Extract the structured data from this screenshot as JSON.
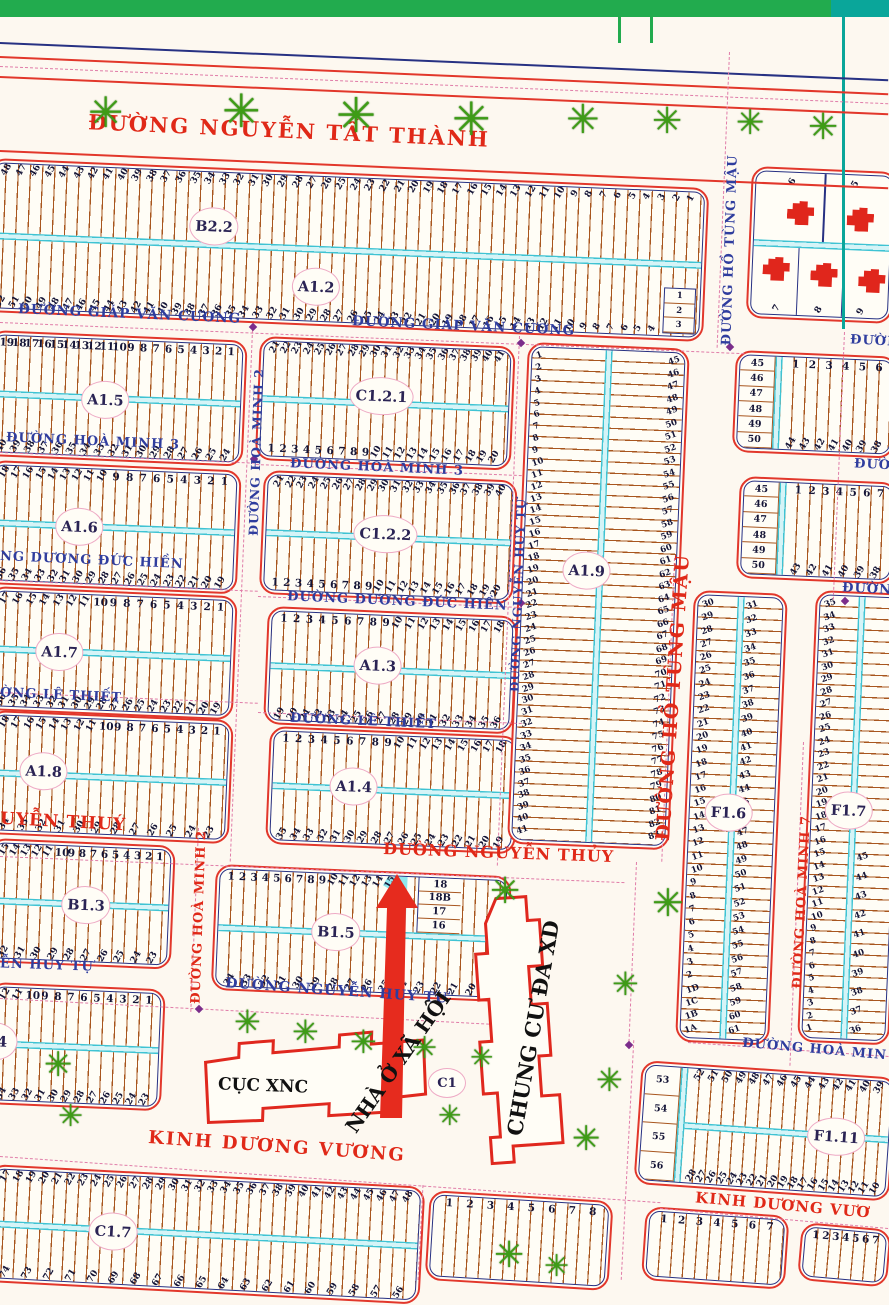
{
  "streets": {
    "nguyen_tat_thanh": "ĐƯỜNG NGUYỄN TẤT THÀNH",
    "giap_van_cuong": "ĐƯỜNG GIÁP VĂN CƯƠNG",
    "ho_tung_mau": "ĐƯỜNG HỒ TÙNG MẬU",
    "hoa_minh_2": "ĐƯỜNG HOÀ MINH 2",
    "hoa_minh_3": "ĐƯỜNG HOÀ MINH 3",
    "hoa_minh_7": "ĐƯỜNG HOÀ MINH 7",
    "hoa_minh_cut": "ĐƯỜNG HOÀ MIN",
    "duong_duc_hien": "ĐƯỜNG DƯƠNG ĐỨC HIỀN",
    "duong_duc_hien_cut": "NG DƯƠNG ĐỨC HIỀN",
    "le_thiet": "ĐƯỜNG LÊ THIẾT",
    "le_thiet_cut": "ỜNG LÊ THIẾT",
    "nguyen_thuy": "ĐƯỜNG NGUYỄN THỦY",
    "nguyen_thuy_cut": "UYỄN THUÝ",
    "nguyen_huy_tu": "ĐƯỜNG NGUYỄN HUY TỰ",
    "nguyen_huy_tu_cut": "ỄN HUY TỰ",
    "kinh_duong_vuong": "KINH DƯƠNG VƯƠNG",
    "kinh_duong_vuong_cut": "KINH DƯƠNG VƯƠ",
    "duong_cut": "ĐƯỜNG"
  },
  "places": {
    "cuc_xnc": "CỤC XNC",
    "nha_o_xa_hoi": "NHÀ Ở XÃ HỘI",
    "chung_cu": "CHUNG CƯ ĐA XD",
    "c1_label": "C1"
  },
  "icons": {
    "tree": "✳"
  },
  "blocks": {
    "b22": {
      "label": "B2.2",
      "top": [
        "48",
        "47",
        "46",
        "45",
        "44",
        "43",
        "42",
        "41",
        "40",
        "39",
        "38",
        "37",
        "36",
        "35",
        "34",
        "33",
        "32",
        "31",
        "30",
        "29",
        "28",
        "27",
        "26",
        "25",
        "24",
        "23",
        "22",
        "21",
        "20",
        "19",
        "18",
        "17",
        "16",
        "15",
        "14",
        "13",
        "12",
        "11",
        "10",
        "9",
        "8",
        "7",
        "6",
        "5",
        "4",
        "3",
        "2",
        "1"
      ]
    },
    "a12": {
      "label": "A1.2",
      "bottom": [
        "52",
        "51",
        "50",
        "49",
        "48",
        "47",
        "46",
        "45",
        "44",
        "43",
        "42",
        "41",
        "40",
        "39",
        "38",
        "37",
        "36",
        "35",
        "34",
        "33",
        "32",
        "31",
        "30",
        "29",
        "28",
        "27",
        "26",
        "25",
        "24",
        "23",
        "22",
        "21",
        "20",
        "19",
        "18",
        "17",
        "16",
        "15",
        "14",
        "13",
        "12",
        "11",
        "10",
        "9",
        "8",
        "7",
        "6",
        "5",
        "4"
      ],
      "corner": [
        "1",
        "2",
        "3"
      ]
    },
    "tr": {
      "top": [
        "6",
        "5"
      ],
      "bottom": [
        "7",
        "8",
        "9"
      ]
    },
    "a15": {
      "label": "A1.5",
      "top": [
        "19",
        "18",
        "17",
        "16",
        "15",
        "14",
        "13",
        "12",
        "11",
        "10",
        "9",
        "8",
        "7",
        "6",
        "5",
        "4",
        "3",
        "2",
        "1"
      ],
      "bottom": [
        "40",
        "39",
        "38",
        "37",
        "36",
        "35",
        "34",
        "33",
        "32",
        "31",
        "30",
        "29",
        "28",
        "27",
        "26",
        "25",
        "24"
      ]
    },
    "a16": {
      "label": "A1.6",
      "toprot": [
        "18",
        "17",
        "16",
        "15",
        "14",
        "13",
        "12",
        "11",
        "10"
      ],
      "topup": [
        "9",
        "8",
        "7",
        "6",
        "5",
        "4",
        "3",
        "2",
        "1"
      ],
      "bottom": [
        "36",
        "35",
        "34",
        "33",
        "32",
        "31",
        "30",
        "29",
        "28",
        "27",
        "26",
        "25",
        "24",
        "23",
        "22",
        "21",
        "20",
        "19"
      ]
    },
    "a17": {
      "label": "A1.7",
      "toprot": [
        "17",
        "16",
        "15",
        "14",
        "13",
        "12",
        "11"
      ],
      "topup": [
        "10",
        "9",
        "8",
        "7",
        "6",
        "5",
        "4",
        "3",
        "2",
        "1"
      ],
      "bottom": [
        "36",
        "35",
        "34",
        "33",
        "32",
        "31",
        "30",
        "29",
        "28",
        "27",
        "26",
        "25",
        "24",
        "23",
        "22",
        "21",
        "20",
        "19"
      ]
    },
    "a18": {
      "label": "A1.8",
      "toprot": [
        "18",
        "17",
        "16",
        "15",
        "14",
        "13",
        "12",
        "11"
      ],
      "topup": [
        "10",
        "9",
        "8",
        "7",
        "6",
        "5",
        "4",
        "3",
        "2",
        "1"
      ],
      "bottom": [
        "34",
        "33",
        "32",
        "31",
        "30",
        "29",
        "28",
        "27",
        "26",
        "25",
        "24",
        "23"
      ]
    },
    "b13": {
      "label": "B1.3",
      "toprot": [
        "15",
        "14",
        "13",
        "12",
        "11"
      ],
      "topup": [
        "10",
        "9",
        "8",
        "7",
        "6",
        "5",
        "4",
        "3",
        "2",
        "1"
      ],
      "bottom": [
        "32",
        "31",
        "30",
        "29",
        "28",
        "27",
        "26",
        "25",
        "24",
        "23"
      ]
    },
    "b14": {
      "label": "1.4",
      "toprot": [
        "12",
        "11"
      ],
      "topup": [
        "10",
        "9",
        "8",
        "7",
        "6",
        "5",
        "4",
        "3",
        "2",
        "1"
      ],
      "bottom": [
        "34",
        "33",
        "32",
        "31",
        "30",
        "29",
        "28",
        "27",
        "26",
        "25",
        "24",
        "23"
      ]
    },
    "c17": {
      "label": "C1.7",
      "top": [
        "17",
        "18",
        "19",
        "20",
        "21",
        "22",
        "23",
        "24",
        "25",
        "26",
        "27",
        "28",
        "29",
        "30",
        "31",
        "32",
        "33",
        "34",
        "35",
        "36",
        "37",
        "38",
        "39",
        "40",
        "41",
        "42",
        "43",
        "44",
        "45",
        "46",
        "47",
        "48"
      ],
      "bottom": [
        "74",
        "73",
        "72",
        "71",
        "70",
        "69",
        "68",
        "67",
        "66",
        "65",
        "64",
        "63",
        "62",
        "61",
        "60",
        "59",
        "58",
        "57",
        "56"
      ]
    },
    "c121": {
      "label": "C1.2.1",
      "top": [
        "21",
        "22",
        "23",
        "24",
        "25",
        "26",
        "27",
        "28",
        "29",
        "30",
        "31",
        "32",
        "33",
        "34",
        "35",
        "36",
        "37",
        "38",
        "39",
        "40",
        "41"
      ],
      "botup": [
        "1",
        "2",
        "3",
        "4",
        "5",
        "6",
        "7",
        "8",
        "9"
      ],
      "botrot": [
        "10",
        "11",
        "12",
        "13",
        "14",
        "15",
        "16",
        "17",
        "18",
        "19",
        "20"
      ]
    },
    "c122": {
      "label": "C1.2.2",
      "top": [
        "21",
        "22",
        "23",
        "24",
        "25",
        "26",
        "27",
        "28",
        "29",
        "30",
        "31",
        "32",
        "33",
        "34",
        "35",
        "36",
        "37",
        "38",
        "39",
        "40"
      ],
      "botup": [
        "1",
        "2",
        "3",
        "4",
        "5",
        "6",
        "7",
        "8",
        "9"
      ],
      "botrot": [
        "10",
        "11",
        "12",
        "13",
        "14",
        "15",
        "16",
        "17",
        "18",
        "19",
        "20"
      ]
    },
    "a13": {
      "label": "A1.3",
      "topup": [
        "1",
        "2",
        "3",
        "4",
        "5",
        "6",
        "7",
        "8",
        "9"
      ],
      "toprot": [
        "10",
        "11",
        "12",
        "13",
        "14",
        "15",
        "16",
        "17",
        "18"
      ],
      "bottom": [
        "19",
        "20",
        "21",
        "22",
        "23",
        "24",
        "25",
        "26",
        "27",
        "28",
        "29",
        "30",
        "31",
        "32",
        "33",
        "34",
        "35",
        "36"
      ]
    },
    "a14": {
      "label": "A1.4",
      "topup": [
        "1",
        "2",
        "3",
        "4",
        "5",
        "6",
        "7",
        "8",
        "9"
      ],
      "toprot": [
        "10",
        "11",
        "12",
        "13",
        "14",
        "15",
        "16",
        "17",
        "18"
      ],
      "bottom": [
        "35",
        "34",
        "33",
        "32",
        "31",
        "30",
        "29",
        "28",
        "27",
        "26",
        "25",
        "24",
        "23",
        "22",
        "21",
        "20",
        "19"
      ]
    },
    "b15": {
      "label": "B1.5",
      "topup": [
        "1",
        "2",
        "3",
        "4",
        "5",
        "6",
        "7",
        "8",
        "9"
      ],
      "toprot": [
        "10",
        "11",
        "12",
        "13",
        "14",
        "15"
      ],
      "side": [
        "18",
        "18B",
        "17",
        "16"
      ],
      "bottom": [
        "34",
        "33",
        "32",
        "31",
        "30",
        "29",
        "28",
        "27",
        "26",
        "25",
        "24",
        "23",
        "22",
        "21",
        "20",
        "19"
      ],
      "highlighted_lot": "15"
    },
    "a19": {
      "label": "A1.9",
      "left": [
        "1",
        "2",
        "3",
        "4",
        "5",
        "6",
        "7",
        "8",
        "9",
        "10",
        "11",
        "12",
        "13",
        "14",
        "15",
        "16",
        "17",
        "18",
        "19",
        "20",
        "21",
        "22",
        "23",
        "24",
        "25",
        "26",
        "27",
        "28",
        "29",
        "30",
        "31",
        "32",
        "33",
        "34",
        "35",
        "36",
        "37",
        "38",
        "39",
        "40",
        "41"
      ],
      "right": [
        "45",
        "46",
        "47",
        "48",
        "49",
        "50",
        "51",
        "52",
        "53",
        "54",
        "55",
        "56",
        "57",
        "58",
        "59",
        "60",
        "61",
        "62",
        "63",
        "64",
        "65",
        "66",
        "67",
        "68",
        "69",
        "70",
        "71",
        "72",
        "73",
        "74",
        "75",
        "76",
        "77",
        "78",
        "79",
        "80",
        "81",
        "82",
        "83"
      ]
    },
    "f16": {
      "label": "F1.6",
      "left": [
        "30",
        "29",
        "28",
        "27",
        "26",
        "25",
        "24",
        "23",
        "22",
        "21",
        "20",
        "19",
        "18",
        "17",
        "16",
        "15",
        "14",
        "13",
        "12",
        "11",
        "10",
        "9",
        "8",
        "7",
        "6",
        "5",
        "4",
        "3",
        "2",
        "1D",
        "1C",
        "1B",
        "1A"
      ],
      "right": [
        "31",
        "32",
        "33",
        "34",
        "35",
        "36",
        "37",
        "38",
        "39",
        "40",
        "41",
        "42",
        "43",
        "44",
        "45",
        "46",
        "47",
        "48",
        "49",
        "50",
        "51",
        "52",
        "53",
        "54",
        "55",
        "56",
        "57",
        "58",
        "59",
        "60",
        "61"
      ]
    },
    "f17": {
      "label": "F1.7",
      "left": [
        "35",
        "34",
        "33",
        "32",
        "31",
        "30",
        "29",
        "28",
        "27",
        "26",
        "25",
        "24",
        "23",
        "22",
        "21",
        "20",
        "19",
        "18",
        "17",
        "16",
        "15",
        "14",
        "13",
        "12",
        "11",
        "10",
        "9",
        "8",
        "7",
        "6",
        "5",
        "4",
        "3",
        "2",
        "1"
      ],
      "right": [
        "45",
        "44",
        "43",
        "42",
        "41",
        "40",
        "39",
        "38",
        "37",
        "36"
      ]
    },
    "f111": {
      "label": "F1.11",
      "side": [
        "53",
        "54",
        "55",
        "56"
      ],
      "top": [
        "52",
        "51",
        "50",
        "49",
        "48",
        "47",
        "46",
        "45",
        "44",
        "43",
        "42",
        "41",
        "40",
        "39"
      ],
      "bottom": [
        "28",
        "27",
        "26",
        "25",
        "24",
        "23",
        "22",
        "21",
        "20",
        "19",
        "18",
        "17",
        "16",
        "15",
        "14",
        "13",
        "12",
        "11",
        "10"
      ]
    },
    "ra": {
      "side": [
        "45",
        "46",
        "47",
        "48",
        "49",
        "50"
      ],
      "top": [
        "1",
        "2",
        "3",
        "4",
        "5",
        "6"
      ],
      "bottom": [
        "44",
        "43",
        "42",
        "41",
        "40",
        "39",
        "38"
      ]
    },
    "rb": {
      "side": [
        "45",
        "46",
        "47",
        "48",
        "49",
        "50"
      ],
      "top": [
        "1",
        "2",
        "3",
        "4",
        "5",
        "6",
        "7"
      ],
      "bottom": [
        "43",
        "42",
        "41",
        "40",
        "39",
        "38"
      ]
    },
    "bb1": {
      "top": [
        "1",
        "2",
        "3",
        "4",
        "5",
        "6",
        "7",
        "8"
      ]
    },
    "bb2": {
      "top": [
        "1",
        "2",
        "3",
        "4",
        "5",
        "6",
        "7"
      ]
    },
    "bb3": {
      "top": [
        "1",
        "2",
        "3",
        "4",
        "5",
        "6",
        "7"
      ]
    }
  }
}
